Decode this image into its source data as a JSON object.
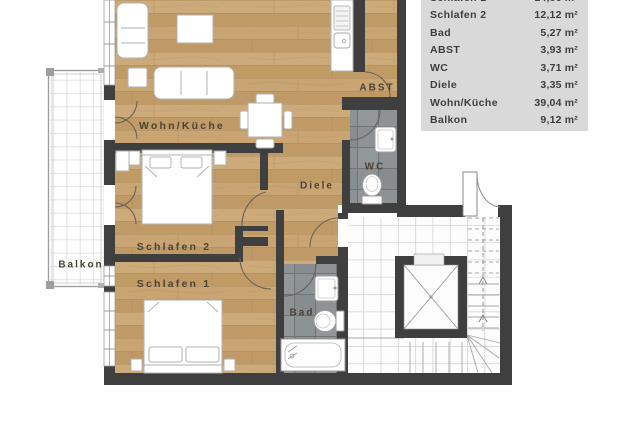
{
  "legend": {
    "rows": [
      {
        "name": "Schlafen 1",
        "area": "14,86 m²"
      },
      {
        "name": "Schlafen 2",
        "area": "12,12 m²"
      },
      {
        "name": "Bad",
        "area": "5,27 m²"
      },
      {
        "name": "ABST",
        "area": "3,93 m²"
      },
      {
        "name": "WC",
        "area": "3,71 m²"
      },
      {
        "name": "Diele",
        "area": "3,35 m²"
      },
      {
        "name": "Wohn/Küche",
        "area": "39,04 m²"
      },
      {
        "name": "Balkon",
        "area": "9,12 m²"
      }
    ]
  },
  "rooms": {
    "wohn_kueche": "Wohn/Küche",
    "schlafen2": "Schlafen 2",
    "schlafen1": "Schlafen 1",
    "diele": "Diele",
    "balkon": "Balkon",
    "bad": "Bad",
    "wc": "WC",
    "abst": "ABST"
  },
  "colors": {
    "wood_floor": "#c6a26f",
    "gray_tile": "#8d9295",
    "wall": "#3f3f3f",
    "legend_bg": "#d9d9d9",
    "white_tile": "#fdfdfd"
  }
}
